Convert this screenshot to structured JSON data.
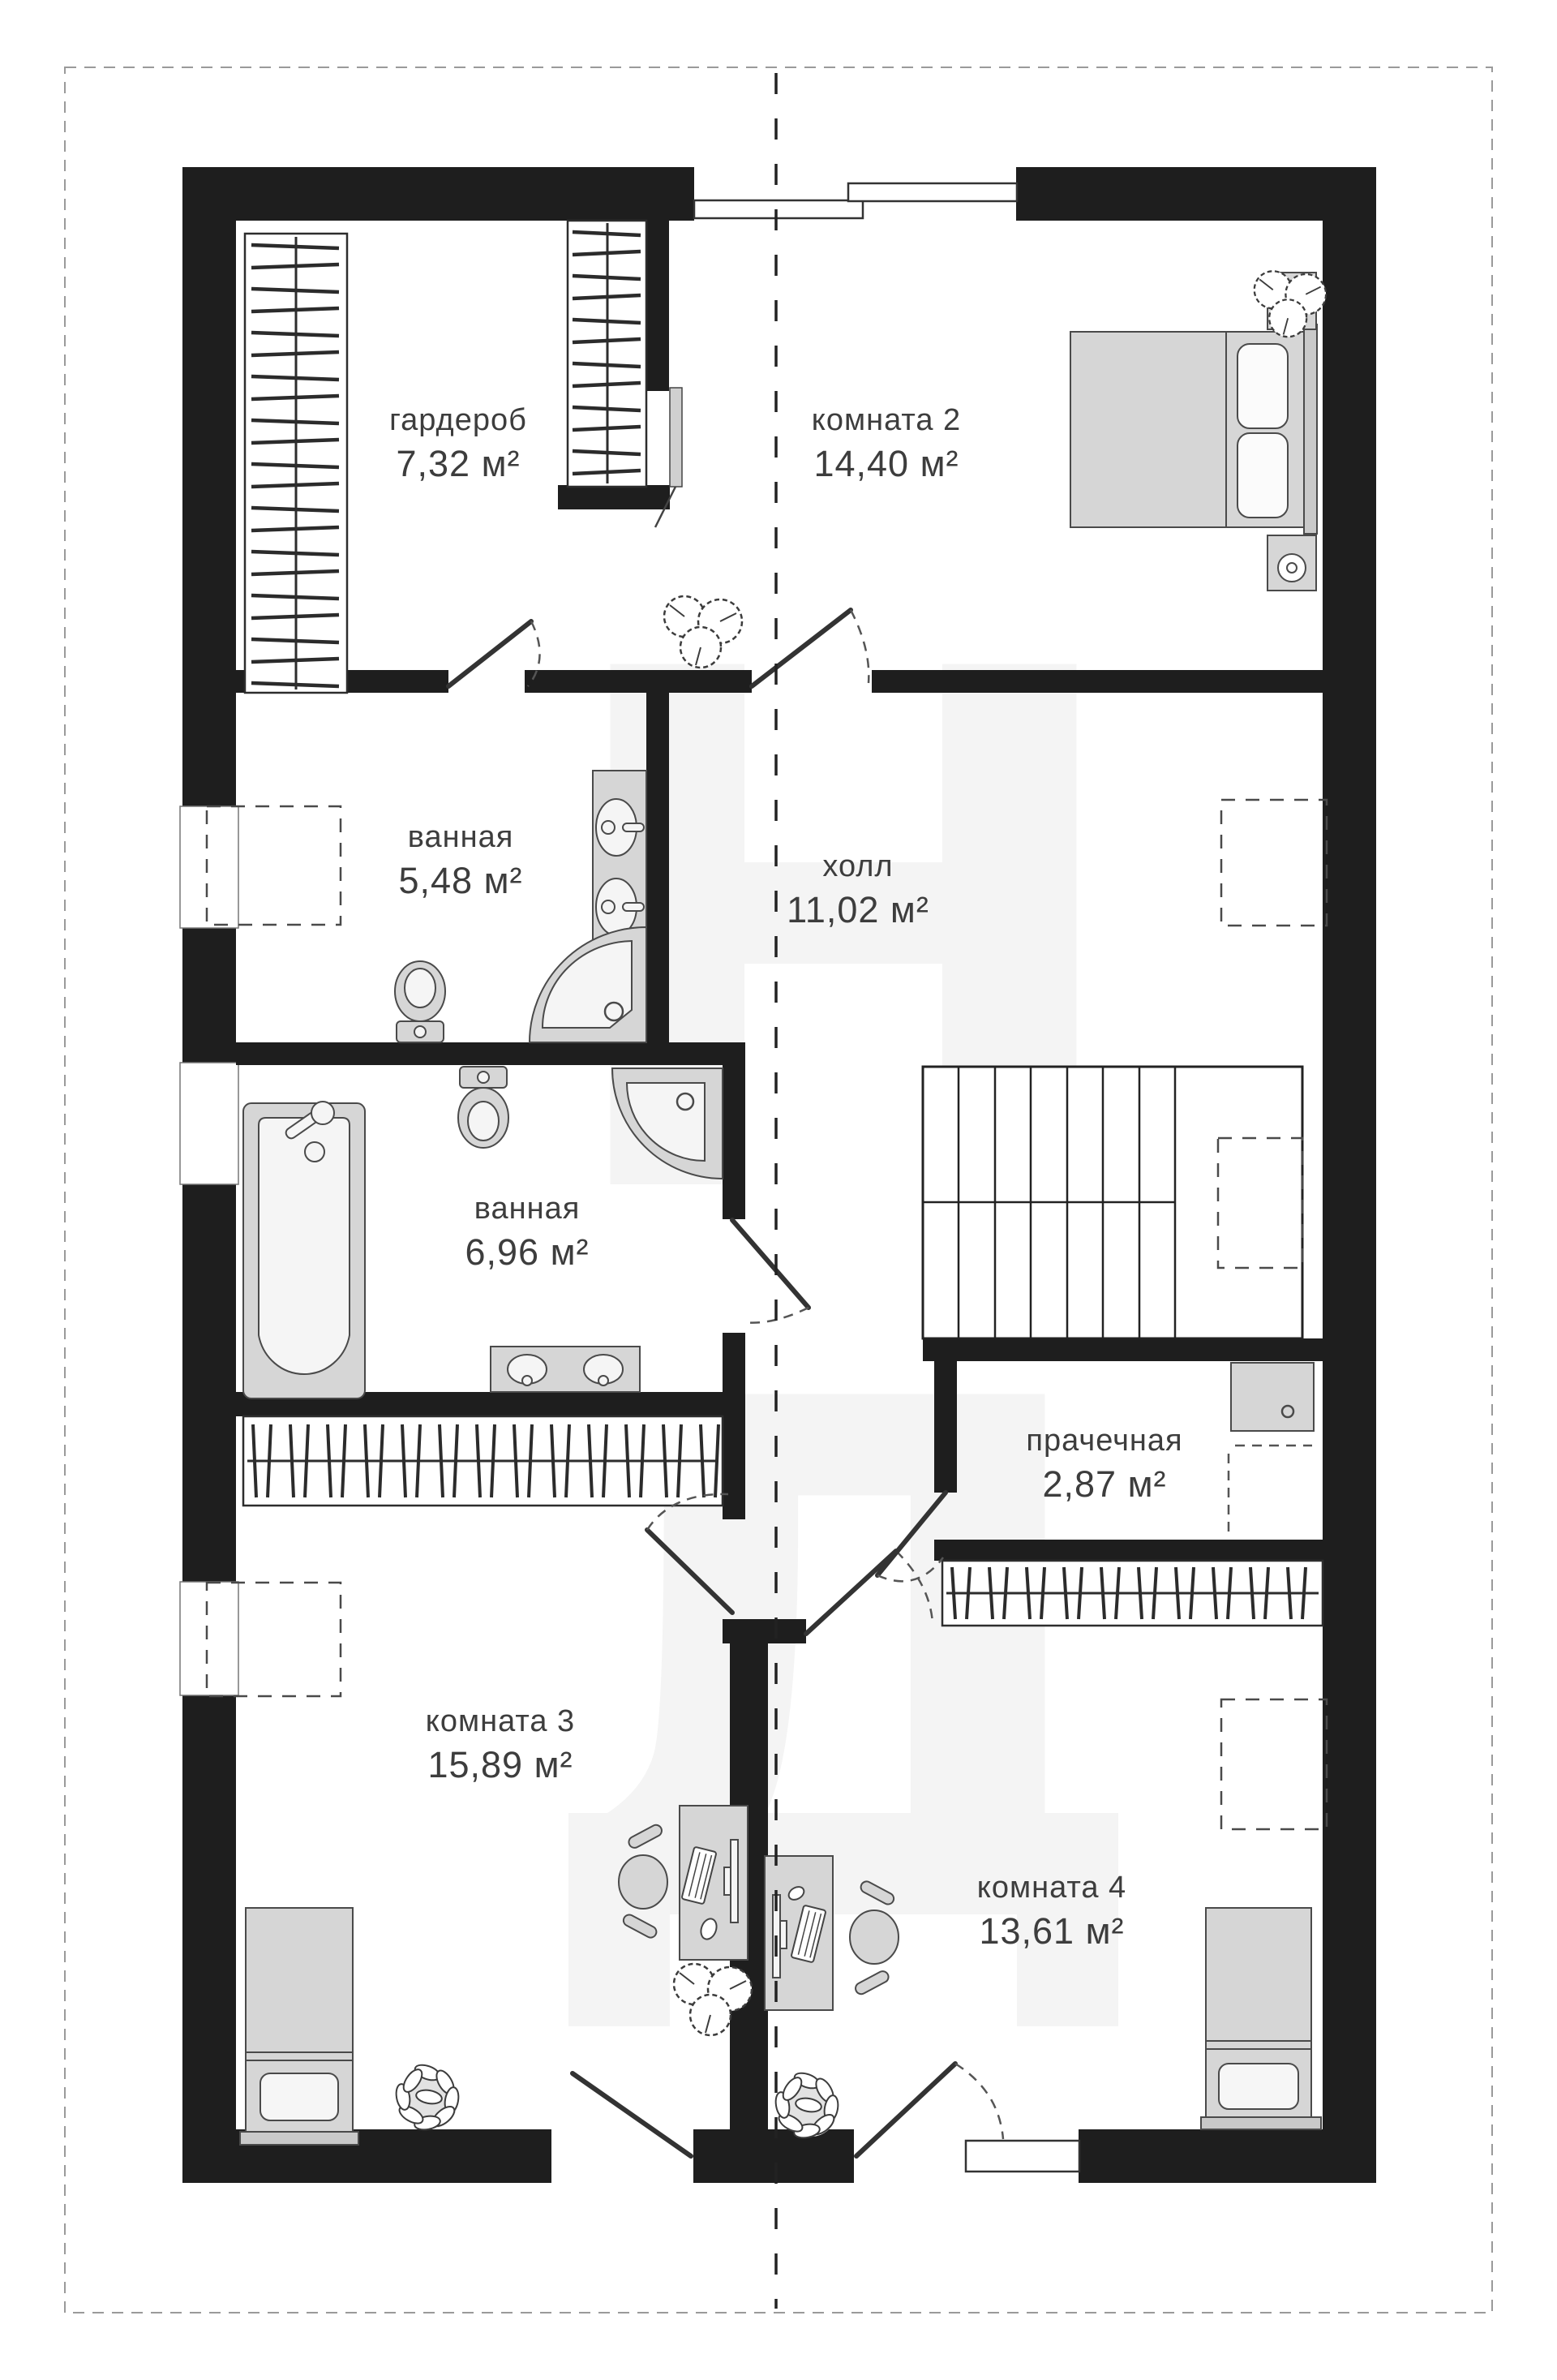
{
  "plan": {
    "type": "floor-plan",
    "floor": "mansard-level apartment plan",
    "rooms": [
      {
        "id": "wardrobe",
        "name": "гардероб",
        "area": "7,32 м²"
      },
      {
        "id": "room2",
        "name": "комната 2",
        "area": "14,40 м²"
      },
      {
        "id": "bathroom1",
        "name": "ванная",
        "area": "5,48 м²"
      },
      {
        "id": "hall",
        "name": "холл",
        "area": "11,02 м²"
      },
      {
        "id": "bathroom2",
        "name": "ванная",
        "area": "6,96 м²"
      },
      {
        "id": "laundry",
        "name": "прачечная",
        "area": "2,87 м²"
      },
      {
        "id": "room3",
        "name": "комната 3",
        "area": "15,89 м²"
      },
      {
        "id": "room4",
        "name": "комната 4",
        "area": "13,61 м²"
      }
    ],
    "watermark_letters": "НД",
    "colors": {
      "wall": "#1e1e1e",
      "furniture": "#d6d6d6",
      "fixture": "#f5f5f5",
      "outline": "#4a4a4a",
      "label": "#3d3d3d",
      "watermark": "#f4f4f4",
      "dash": "#9a9a9a"
    }
  }
}
